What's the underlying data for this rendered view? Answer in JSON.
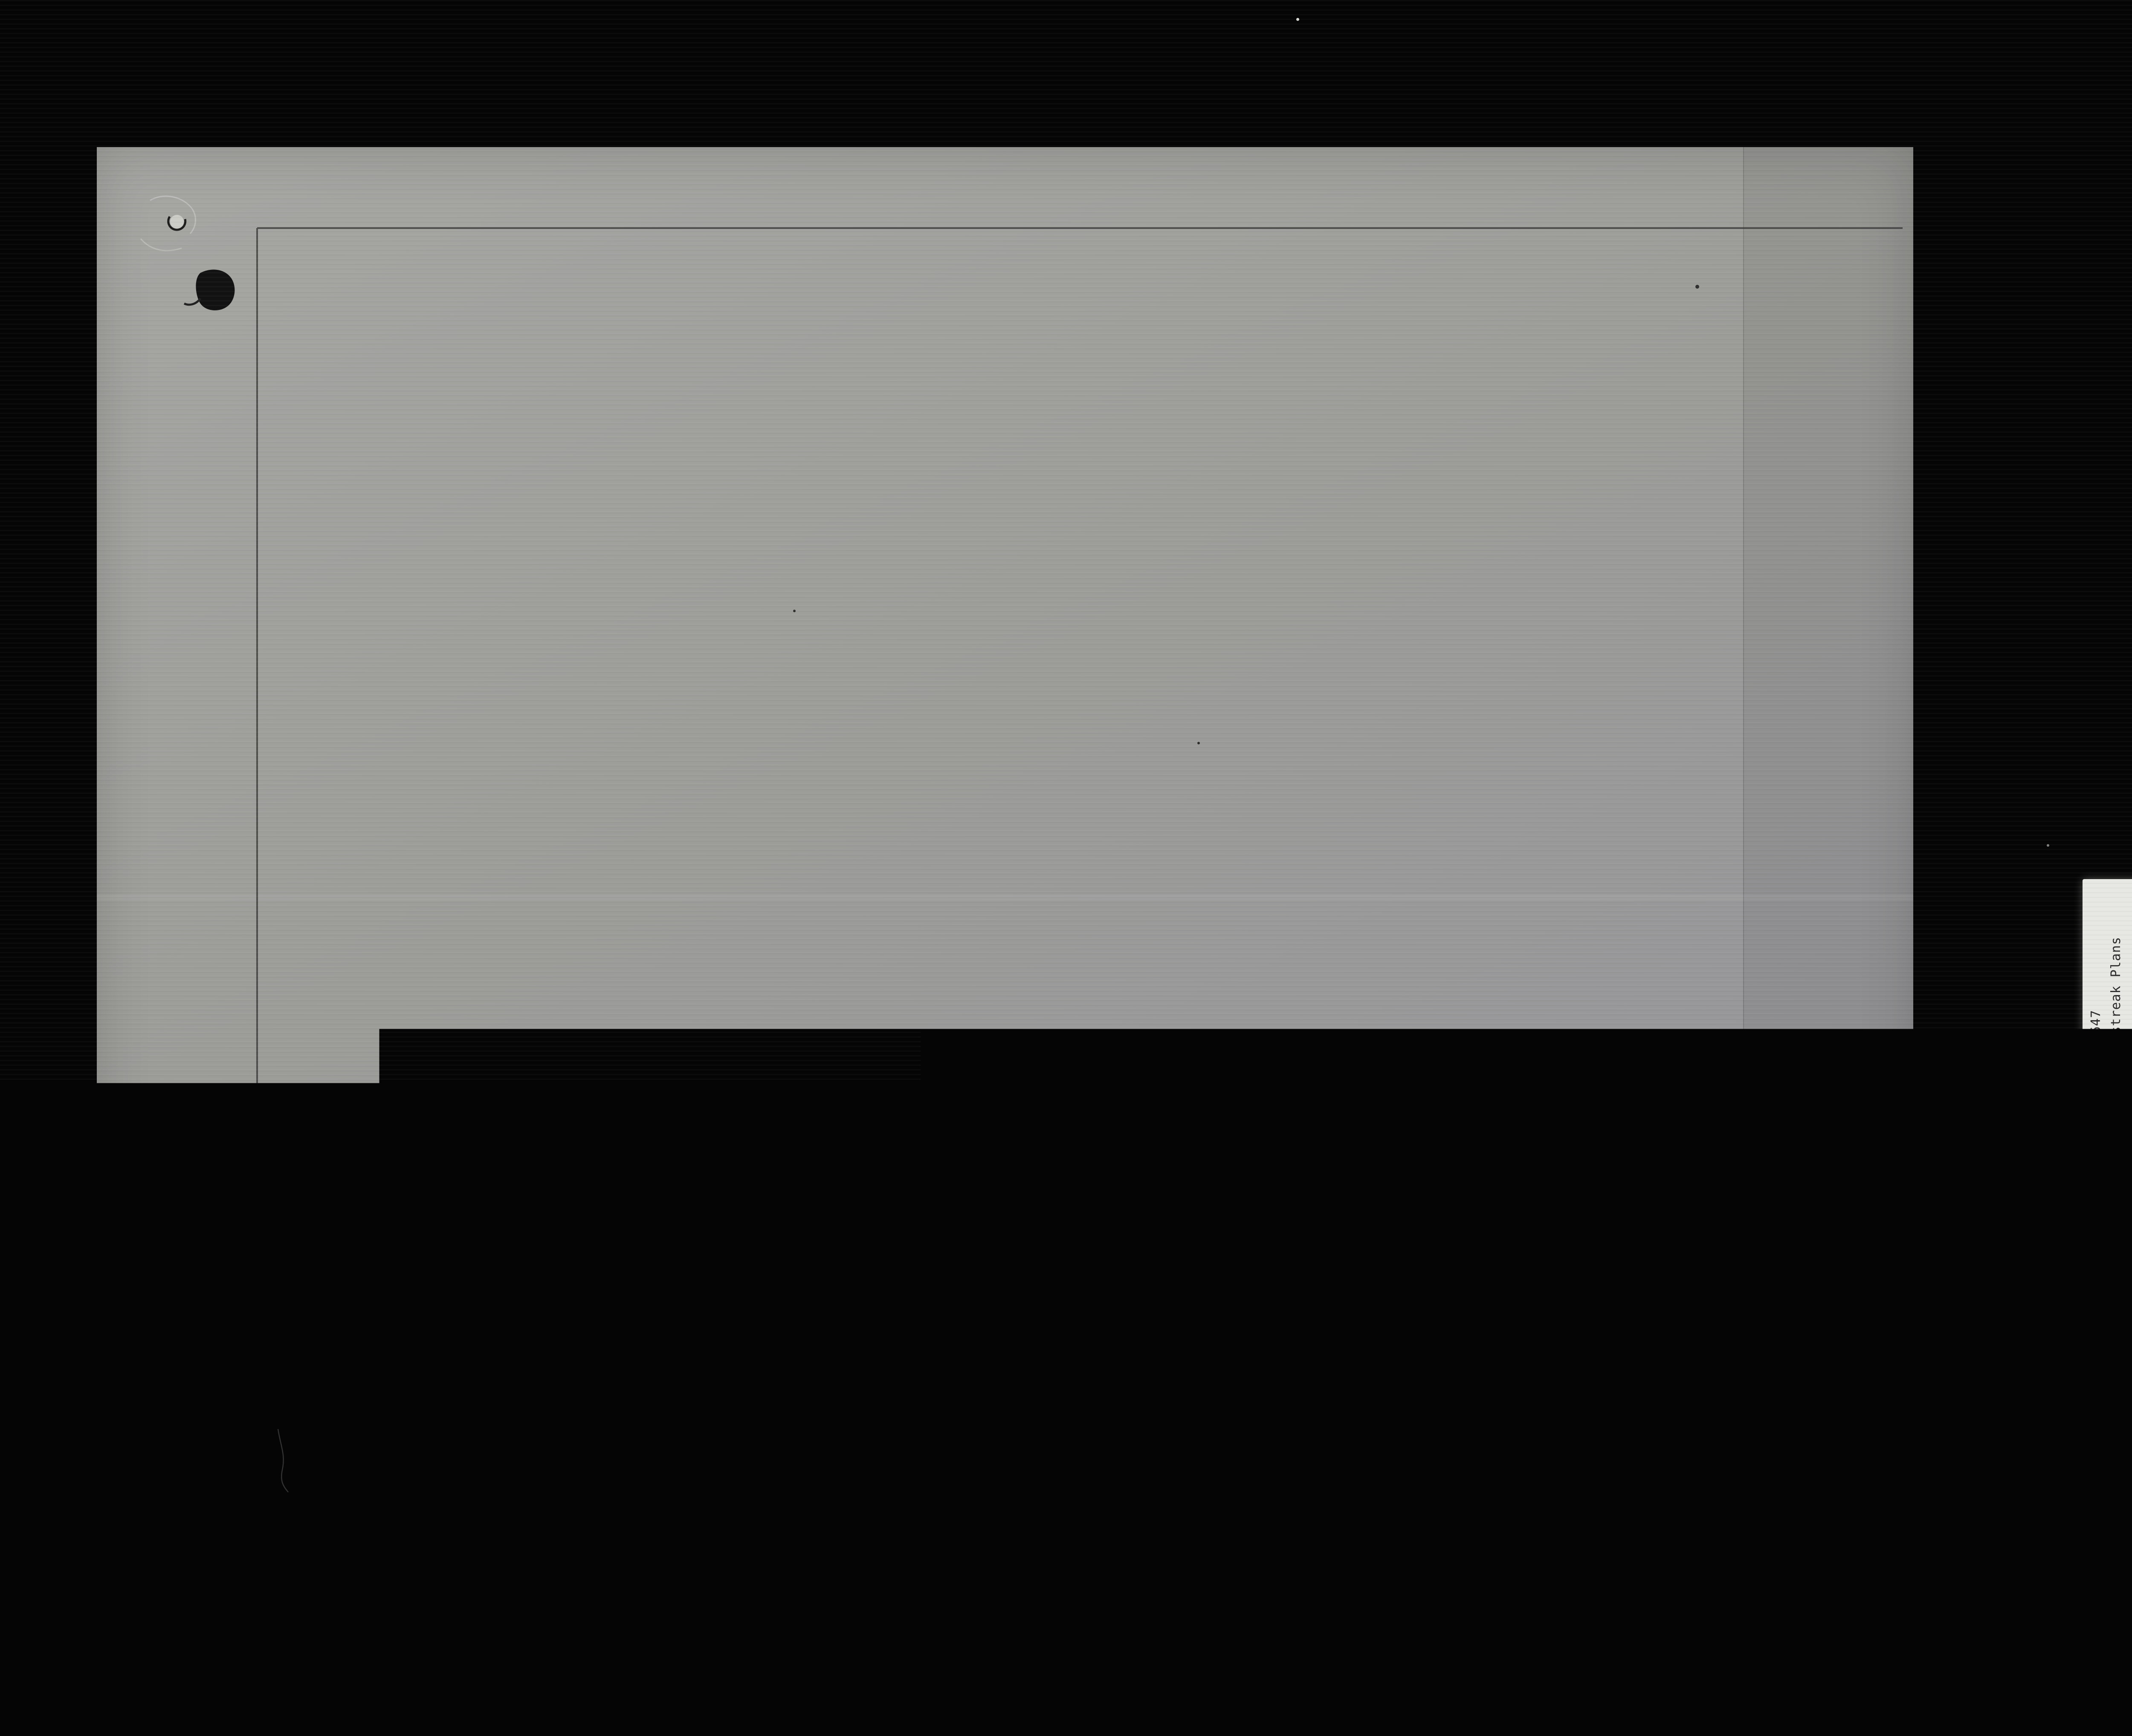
{
  "film": {
    "counter": "000070",
    "index_label": "1 OF / DE"
  },
  "labels": {
    "archive": [
      "RG 84, A-2-a, vol. 1647",
      "File/dossier K36 Redstreak Plans",
      "pt 1"
    ],
    "parks": [
      "PARKS CANADA",
      "PARCS CANADA"
    ],
    "national_archives": [
      "National Archives of Canada",
      "Archives nationales du Canada"
    ]
  },
  "plan": {
    "propane_label": "Propane Gas line",
    "gas_mark": "G",
    "plenum": [
      "Furnace",
      "Plenum"
    ],
    "diffuser_left": [
      "4\" Neck Size",
      "Half Round",
      "Ceiling",
      "Diffuser",
      "Model EH-8"
    ],
    "diffuser_right": [
      "4\" Neck Size",
      "Half Round",
      "Ceiling",
      "Diffuser",
      "Model EH-8"
    ],
    "diffuser_bottom_left": [
      "8\"∅ Neck Size",
      "Ceiling Diffuser",
      "Model E3-8"
    ],
    "diffuser_bottom_right": [
      "8\"∅ Neck Size",
      "Ceiling Diffuser",
      "Model E3-8"
    ],
    "ducts": {
      "main_upper": "16\"x16\"",
      "main_lower": "16\"x8\"",
      "branch_right": "10\" x 4\"",
      "bottom_left": "16\"x6\"",
      "bottom_right": "12\" x 6\""
    }
  },
  "colors": {
    "film_black": "#050505",
    "paper_gray": "#9c9c99",
    "ink": "#333333",
    "strip_white": "#e7e7e3"
  }
}
